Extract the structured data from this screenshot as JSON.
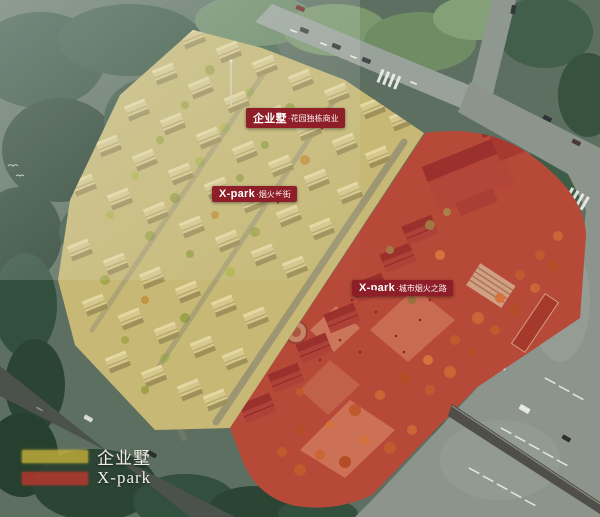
{
  "scene": {
    "description": "Aerial masterplan rendering with two highlighted development zones",
    "zones": [
      {
        "id": "qiyeshu",
        "name": "企业墅",
        "overlay_color": "#d8c553"
      },
      {
        "id": "xpark",
        "name": "X-park",
        "overlay_color": "#c03a2e"
      }
    ]
  },
  "callouts": [
    {
      "brand": "企业墅",
      "desc": "·花园独栋商业"
    },
    {
      "brand": "X-park",
      "desc": "·烟火长街"
    },
    {
      "brand": "X-park",
      "desc": "·城市烟火之路"
    }
  ],
  "legend": {
    "items": [
      {
        "label": "企业墅",
        "swatch_color": "#c5b039"
      },
      {
        "label": "X-park",
        "swatch_color": "#ba372d"
      }
    ]
  }
}
